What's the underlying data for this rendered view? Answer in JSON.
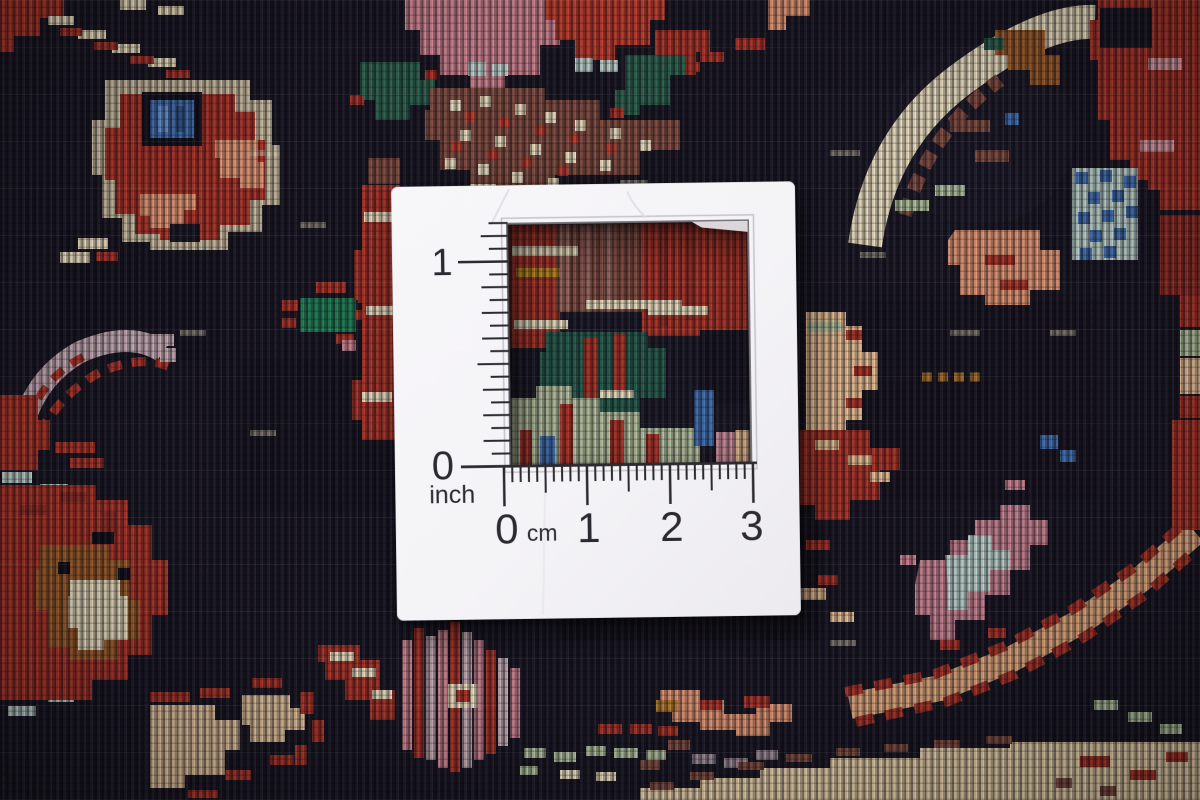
{
  "card": {
    "inch_scale": {
      "one": "1",
      "zero": "0",
      "unit": "inch"
    },
    "cm_scale": {
      "zero": "0",
      "unit": "cm",
      "one": "1",
      "two": "2",
      "three": "3"
    }
  },
  "colors": {
    "card_face": "#f4f3f6",
    "ink": "#2b2a30",
    "carpet_background": "#181622",
    "red": "#a93226",
    "dark_red": "#8e2a22",
    "cream": "#e9ddbd",
    "tan": "#dfc09a",
    "salmon": "#dd9270",
    "peach": "#e7bd92",
    "maroon": "#7e4a3e",
    "sienna": "#9a5a28",
    "rose": "#c8808c",
    "lilac": "#c0a6ae",
    "mauve": "#9a8a95",
    "green": "#2a5f4b",
    "bright_green": "#1f7a52",
    "sage": "#adbd99",
    "pale_blue": "#b9cfc8",
    "blue": "#3e6cac",
    "gold": "#b8861f"
  }
}
